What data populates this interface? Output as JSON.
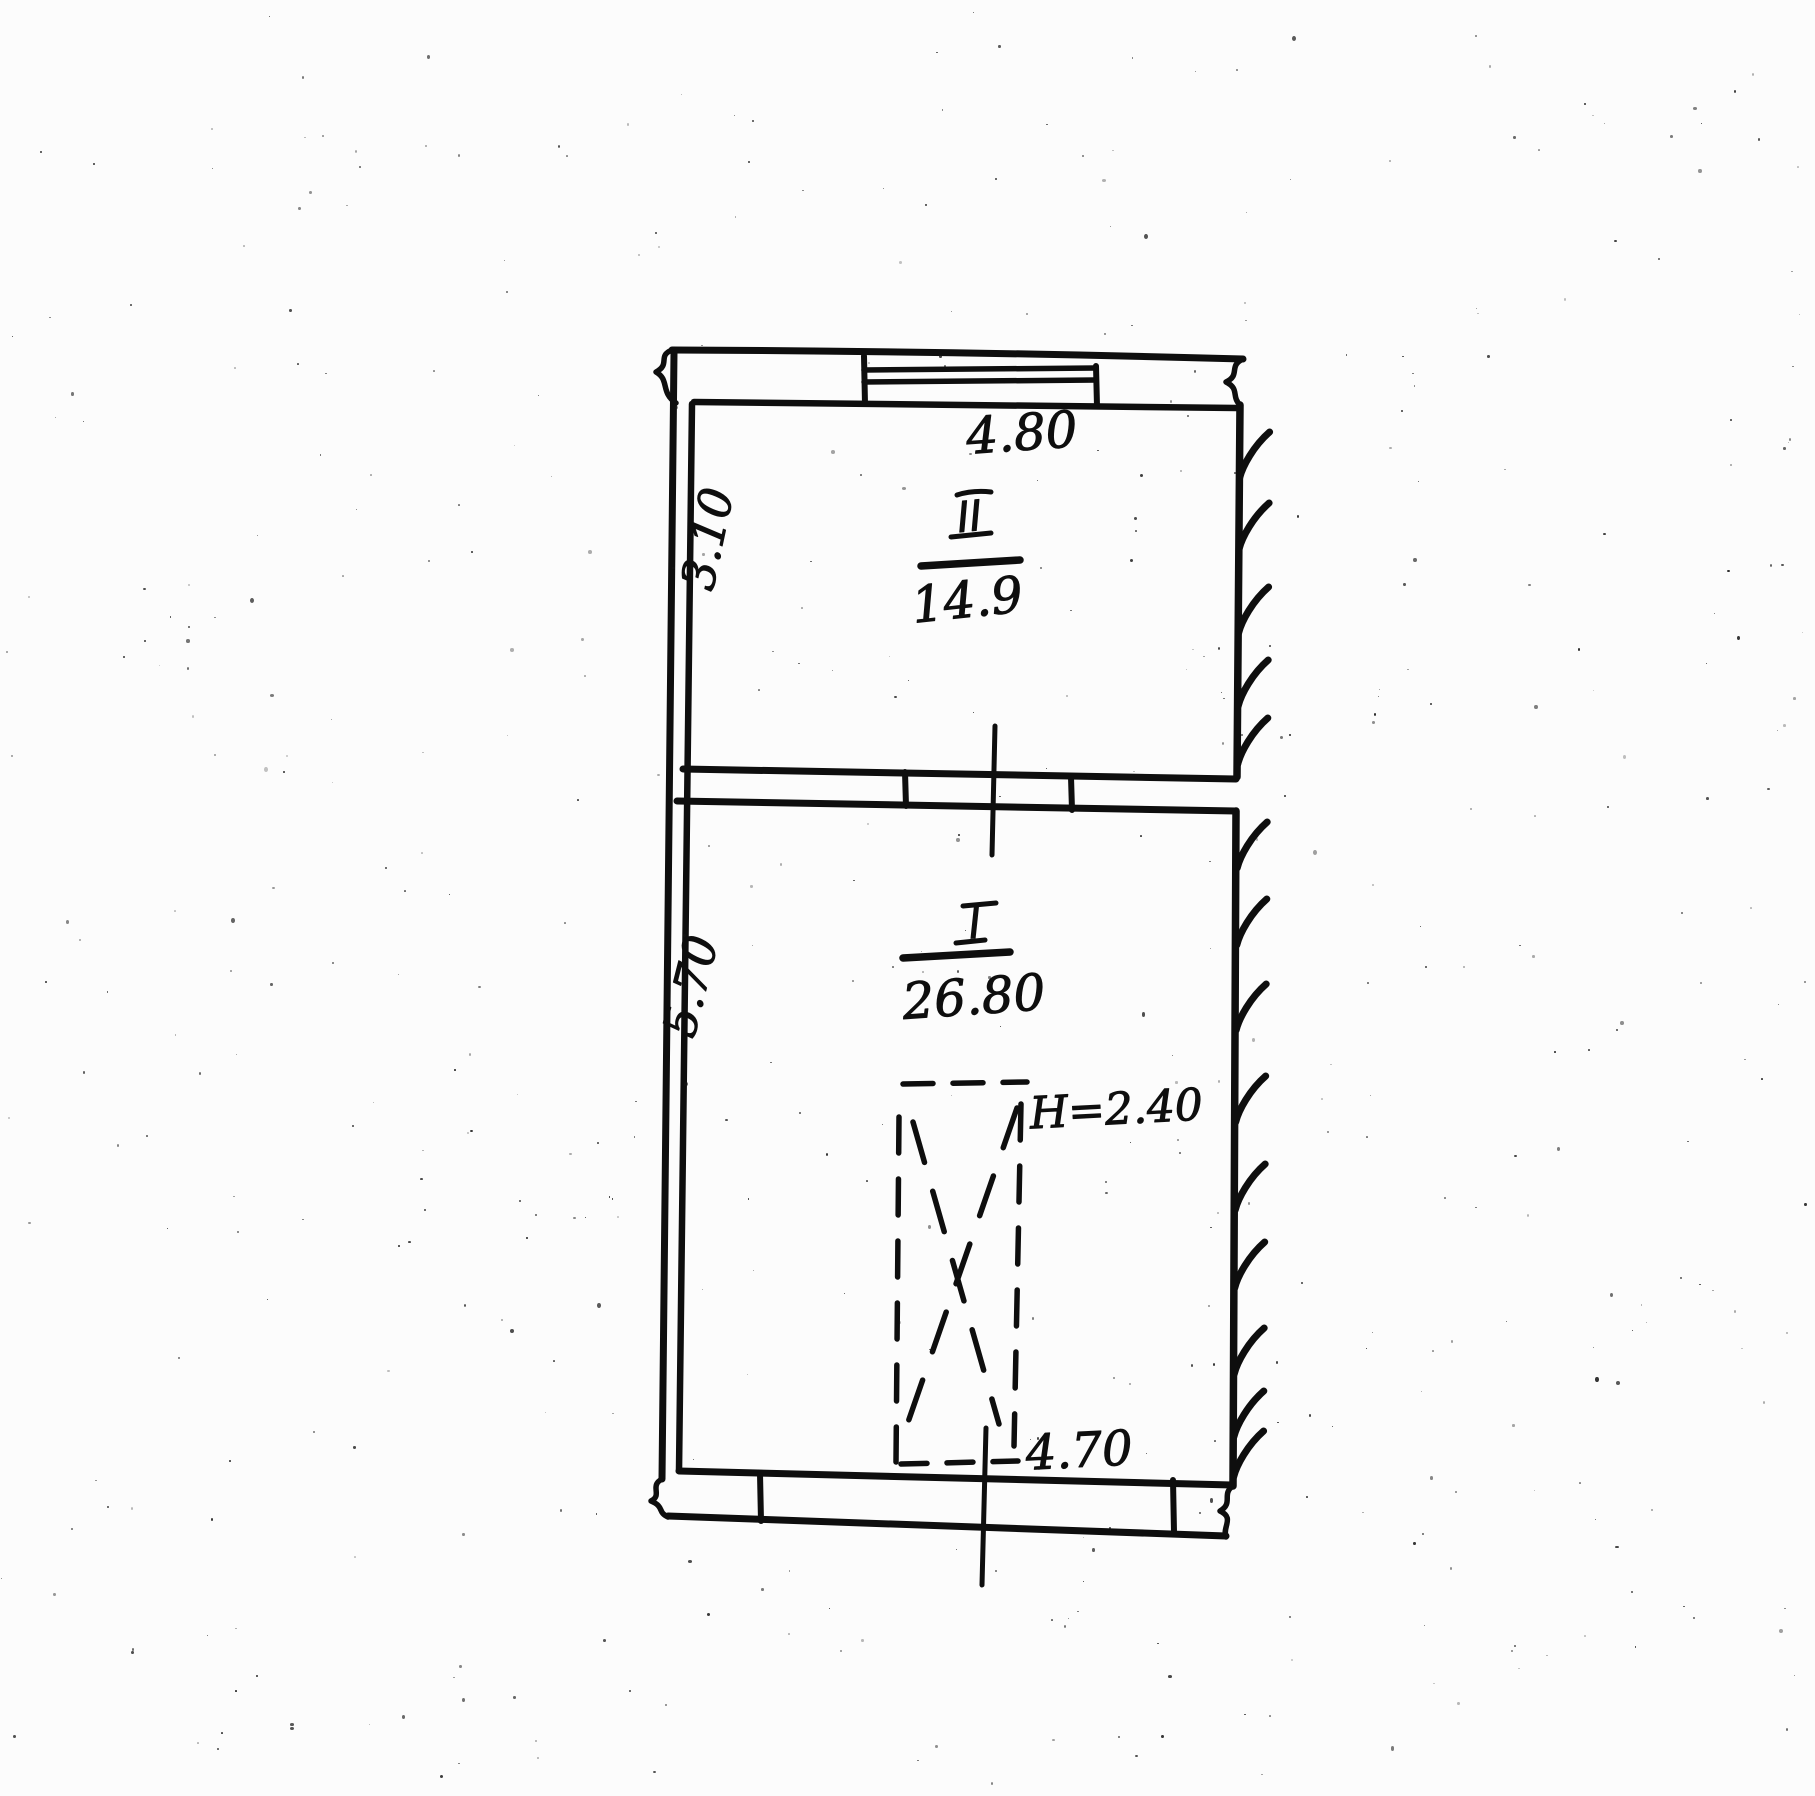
{
  "page": {
    "ink_color": "#0e0e0e",
    "paper_color": "#fcfcfc"
  },
  "plan": {
    "upper_room": {
      "numeral": "II",
      "area": "14.9",
      "top_width": "4.80",
      "left_depth": "3.10"
    },
    "lower_room": {
      "numeral": "I",
      "area": "26.80",
      "bottom_width": "4.70",
      "left_depth": "5.70",
      "ceiling_height": "H=2.40"
    }
  }
}
